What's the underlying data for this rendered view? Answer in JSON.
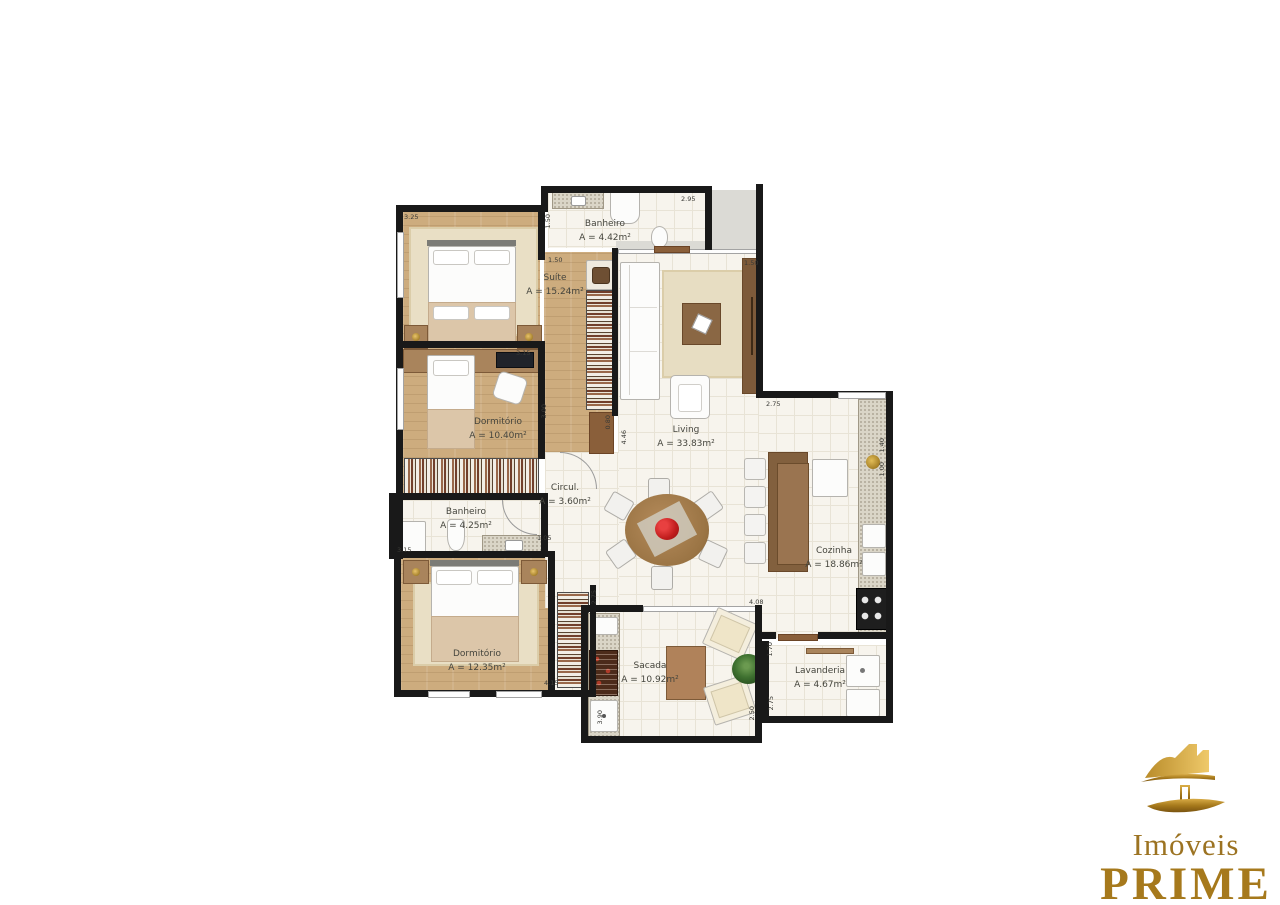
{
  "rooms": {
    "suite": {
      "name": "Suíte",
      "area": "A = 15.24m²"
    },
    "banheiro_suite": {
      "name": "Banheiro",
      "area": "A = 4.42m²"
    },
    "dormitorio1": {
      "name": "Dormitório",
      "area": "A = 10.40m²"
    },
    "banheiro_social": {
      "name": "Banheiro",
      "area": "A = 4.25m²"
    },
    "dormitorio2": {
      "name": "Dormitório",
      "area": "A = 12.35m²"
    },
    "circulacao": {
      "name": "Circul.",
      "area": "A = 3.60m²"
    },
    "living": {
      "name": "Living",
      "area": "A = 33.83m²"
    },
    "cozinha": {
      "name": "Cozinha",
      "area": "A = 18.86m²"
    },
    "sacada": {
      "name": "Sacada",
      "area": "A = 10.92m²"
    },
    "lavanderia": {
      "name": "Lavanderia",
      "area": "A = 4.67m²"
    }
  },
  "dims": {
    "suite_top": "3.25",
    "banheiro_suite_top": "2.95",
    "banheiro_suite_left": "1.50",
    "suite_closet": "1.50",
    "painel_tv": "1.50",
    "dorm1_top": "3.15",
    "circul_altura": "3.00",
    "porta_closet": "0.80",
    "living_left": "4.46",
    "cozinha_top": "2.75",
    "banheiro_social_left": "3.15",
    "banheiro_social_right": "1.05",
    "dorm2_bottom": "4.15",
    "sacada_wall_left": "2.75",
    "sacada_top": "4.08",
    "sacada_bottom": "3.90",
    "sacada_right": "2.50",
    "lavanderia_left_top": "1.70",
    "lavanderia_left_bottom": "2.75",
    "cozinha_right_top": "1.40",
    "cozinha_right_bottom": "1.00"
  },
  "logo": {
    "imoveis": "Imóveis",
    "prime": "PRIME",
    "tagline": "Investimentos Imobiliários",
    "gold": "#a6791c"
  }
}
